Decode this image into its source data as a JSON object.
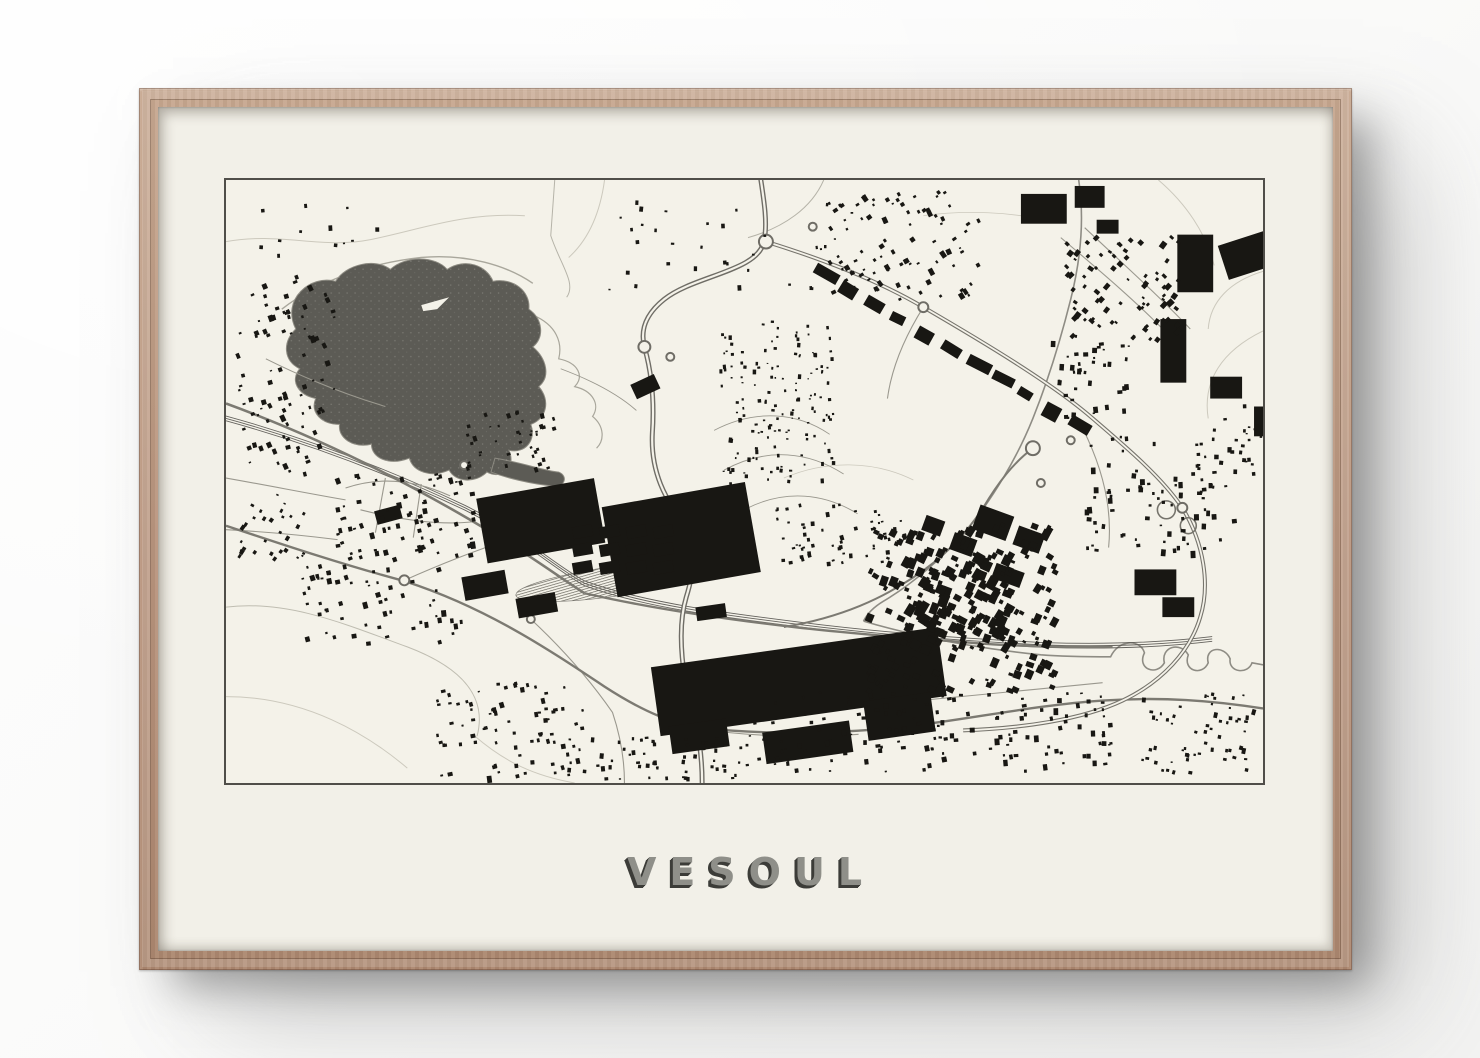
{
  "poster": {
    "title": "VESOUL"
  },
  "map": {
    "features": [
      {
        "name": "lake"
      },
      {
        "name": "lake-island"
      },
      {
        "name": "river"
      },
      {
        "name": "stream"
      },
      {
        "name": "railway"
      },
      {
        "name": "railway-yard"
      },
      {
        "name": "highway"
      },
      {
        "name": "eastern-bypass"
      },
      {
        "name": "main-roads"
      },
      {
        "name": "minor-roads"
      },
      {
        "name": "roundabouts"
      },
      {
        "name": "contour-lines"
      },
      {
        "name": "industrial-buildings"
      },
      {
        "name": "city-center-buildings"
      },
      {
        "name": "residential-buildings"
      }
    ]
  },
  "palette": {
    "wall": "#fbfbfa",
    "wall_shadow": "#9a9a9a",
    "frame_wood": "#bb9780",
    "frame_wood_light": "#c7a890",
    "frame_wood_dark": "#ac876f",
    "paper": "#f2f0e8",
    "map_background": "#f4f2e9",
    "map_border": "#504e49",
    "building": "#181713",
    "lake": "#5c5b55",
    "road_minor": "#9a988e",
    "road_major": "#7c7a72",
    "road_casing": "#6f6d66",
    "river": "#8e8c84",
    "contour": "#ccc9bd",
    "railway": "#55534e",
    "title_fill": "#8f8f89",
    "title_shadow": "#3c3c38"
  }
}
